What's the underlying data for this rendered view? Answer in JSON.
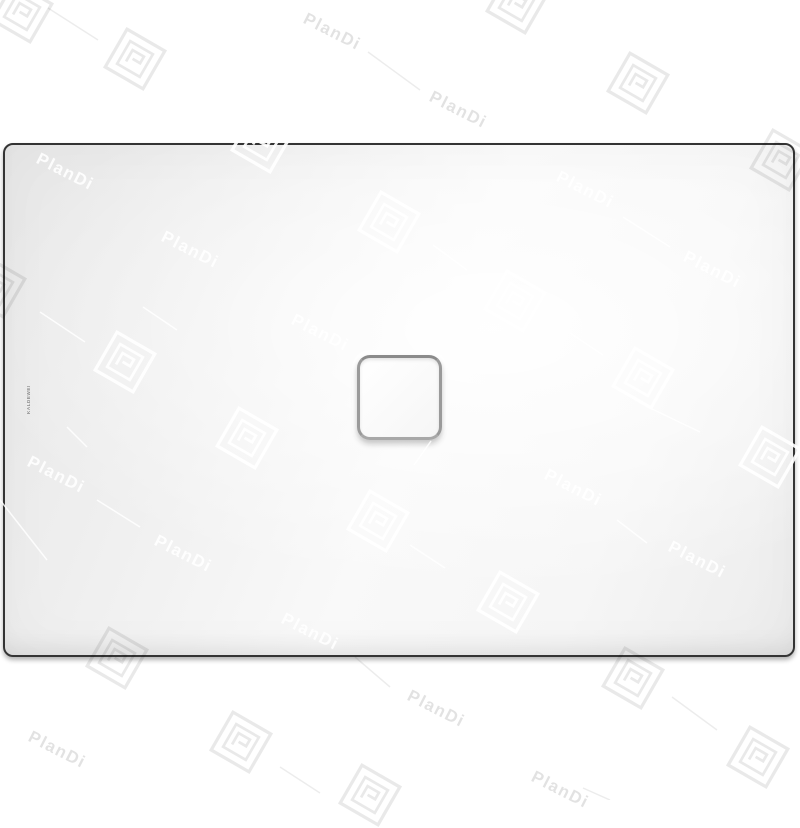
{
  "page": {
    "background": "#ffffff"
  },
  "product": {
    "type": "rectangular shower tray with square center drain",
    "brand_marking": "KALDEWEI",
    "tray": {
      "outline_color": "#343434",
      "surface_light": "#f9f9f9",
      "surface_shade": "#e7e7e7"
    },
    "drain": {
      "ring_color": "#9a9a9a",
      "fill": "#fbfbfb"
    }
  },
  "watermark": {
    "label": "PlanDi",
    "gray_color": "#e2e2e2",
    "white_color": "rgba(255,255,255,0.88)",
    "texts": [
      {
        "x": 332,
        "y": 32,
        "tone": "gray"
      },
      {
        "x": 458,
        "y": 110,
        "tone": "gray"
      },
      {
        "x": 65,
        "y": 172,
        "tone": "white"
      },
      {
        "x": 585,
        "y": 190,
        "tone": "white"
      },
      {
        "x": 190,
        "y": 250,
        "tone": "white"
      },
      {
        "x": 712,
        "y": 270,
        "tone": "white"
      },
      {
        "x": 320,
        "y": 333,
        "tone": "white"
      },
      {
        "x": 56,
        "y": 475,
        "tone": "white"
      },
      {
        "x": 573,
        "y": 488,
        "tone": "white"
      },
      {
        "x": 183,
        "y": 554,
        "tone": "white"
      },
      {
        "x": 697,
        "y": 560,
        "tone": "white"
      },
      {
        "x": 310,
        "y": 632,
        "tone": "white"
      },
      {
        "x": 436,
        "y": 709,
        "tone": "gray"
      },
      {
        "x": 57,
        "y": 750,
        "tone": "gray"
      },
      {
        "x": 560,
        "y": 790,
        "tone": "gray"
      }
    ],
    "logos": [
      {
        "x": 22,
        "y": 12,
        "tone": "gray"
      },
      {
        "x": 135,
        "y": 59,
        "tone": "gray"
      },
      {
        "x": 517,
        "y": 3,
        "tone": "gray"
      },
      {
        "x": 638,
        "y": 83,
        "tone": "gray"
      },
      {
        "x": 781,
        "y": 160,
        "tone": "gray"
      },
      {
        "x": -5,
        "y": 287,
        "tone": "gray"
      },
      {
        "x": 262,
        "y": 142,
        "tone": "white"
      },
      {
        "x": 389,
        "y": 222,
        "tone": "white"
      },
      {
        "x": 515,
        "y": 301,
        "tone": "white"
      },
      {
        "x": 125,
        "y": 362,
        "tone": "white"
      },
      {
        "x": 643,
        "y": 378,
        "tone": "white"
      },
      {
        "x": 770,
        "y": 457,
        "tone": "white"
      },
      {
        "x": 247,
        "y": 438,
        "tone": "white"
      },
      {
        "x": 378,
        "y": 521,
        "tone": "white"
      },
      {
        "x": 508,
        "y": 602,
        "tone": "white"
      },
      {
        "x": 117,
        "y": 658,
        "tone": "gray"
      },
      {
        "x": 241,
        "y": 742,
        "tone": "gray"
      },
      {
        "x": 633,
        "y": 678,
        "tone": "gray"
      },
      {
        "x": 758,
        "y": 757,
        "tone": "gray"
      },
      {
        "x": 370,
        "y": 795,
        "tone": "gray"
      }
    ],
    "lines": [
      {
        "x1": 48,
        "y1": 8,
        "x2": 98,
        "y2": 40,
        "tone": "gray"
      },
      {
        "x1": 368,
        "y1": 52,
        "x2": 420,
        "y2": 90,
        "tone": "gray"
      },
      {
        "x1": 623,
        "y1": 217,
        "x2": 670,
        "y2": 247,
        "tone": "white"
      },
      {
        "x1": 433,
        "y1": 245,
        "x2": 467,
        "y2": 270,
        "tone": "white"
      },
      {
        "x1": 40,
        "y1": 312,
        "x2": 85,
        "y2": 342,
        "tone": "white"
      },
      {
        "x1": 143,
        "y1": 307,
        "x2": 177,
        "y2": 330,
        "tone": "white"
      },
      {
        "x1": 570,
        "y1": 333,
        "x2": 603,
        "y2": 355,
        "tone": "white"
      },
      {
        "x1": 67,
        "y1": 427,
        "x2": 87,
        "y2": 447,
        "tone": "white"
      },
      {
        "x1": 0,
        "y1": 500,
        "x2": 47,
        "y2": 560,
        "tone": "white"
      },
      {
        "x1": 97,
        "y1": 500,
        "x2": 140,
        "y2": 527,
        "tone": "white"
      },
      {
        "x1": 414,
        "y1": 465,
        "x2": 431,
        "y2": 441,
        "tone": "white"
      },
      {
        "x1": 410,
        "y1": 545,
        "x2": 445,
        "y2": 568,
        "tone": "white"
      },
      {
        "x1": 650,
        "y1": 408,
        "x2": 700,
        "y2": 432,
        "tone": "white"
      },
      {
        "x1": 617,
        "y1": 520,
        "x2": 647,
        "y2": 543,
        "tone": "white"
      },
      {
        "x1": 355,
        "y1": 657,
        "x2": 390,
        "y2": 687,
        "tone": "gray"
      },
      {
        "x1": 280,
        "y1": 767,
        "x2": 320,
        "y2": 793,
        "tone": "gray"
      },
      {
        "x1": 672,
        "y1": 697,
        "x2": 717,
        "y2": 730,
        "tone": "gray"
      },
      {
        "x1": 583,
        "y1": 788,
        "x2": 610,
        "y2": 800,
        "tone": "gray"
      }
    ]
  }
}
